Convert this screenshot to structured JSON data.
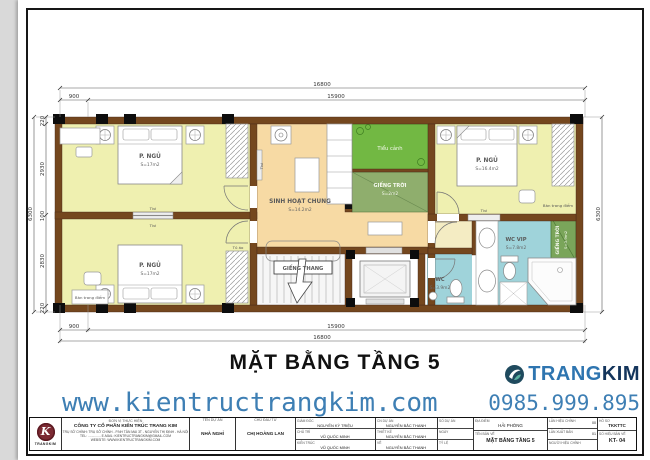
{
  "sheet": {
    "title": "MẶT BẰNG TẦNG 5"
  },
  "dims": {
    "total": "16800",
    "left": "900",
    "main": "15900",
    "height_total": "6300",
    "h_segments": [
      "220",
      "2930",
      "100",
      "2830",
      "220"
    ]
  },
  "rooms": {
    "bedroom1": {
      "name": "P. NGỦ",
      "area": "S=17m2"
    },
    "bedroom2": {
      "name": "P. NGỦ",
      "area": "S=17m2"
    },
    "bedroom3": {
      "name": "P. NGỦ",
      "area": "S=16.4m2"
    },
    "living": {
      "name": "SINH HOẠT CHUNG",
      "area": "S=14.2m2"
    },
    "garden": {
      "name": "Tiểu cảnh"
    },
    "skylight_mid": {
      "name": "GIẾNG TRỜI",
      "area": "S=2m2"
    },
    "skylight_right": {
      "name": "GIẾNG TRỜI",
      "area": "S=3.9m2"
    },
    "stairwell": {
      "name": "GIẾNG THANG"
    },
    "wc": {
      "name": "WC",
      "area": "S=3.9m2"
    },
    "wc_vip": {
      "name": "WC VIP",
      "area": "S=7.8m2"
    }
  },
  "furniture": {
    "tv": "Tivi",
    "wardrobe": "Tủ áo",
    "dressing_table": "Bàn trang điểm"
  },
  "footer": {
    "website": "www.kientructrangkim.com",
    "phone": "0985.999.895",
    "brand_part1": "TRANG",
    "brand_part2": "KIM"
  },
  "titleblock": {
    "unit_header": "ĐƠN VỊ THỰC HIỆN",
    "company": "CÔNG TY CỔ PHẦN KIẾN TRÚC TRANG KIM",
    "address": "TRỤ SỞ CHÍNH: TRỤ SỞ CHÍNH - P.NH TÂN MAI 3T - NGUYỄN THỊ ĐỊNH - HÀ NỘI",
    "tel_line": "TEL: ..............  E-MAIL: KIENTRUCTRANGKIM@GMAIL.COM",
    "website_line": "WEBSITE: WWW.KIENTRUCTRANGKIM.COM",
    "logo_caption": "TRANGKIM",
    "project_label": "TÊN DỰ ÁN",
    "project_value": "NHÀ NGHỈ",
    "investor_label": "CHỦ ĐẦU TƯ",
    "investor_value": "CHỊ HOÀNG LAN",
    "director_label": "GIÁM ĐỐC",
    "director_value": "NGUYỄN KỲ TRIỆU",
    "lead_label": "CHỦ TRÌ",
    "lead_value": "VŨ QUỐC MINH",
    "arch_label": "KIẾN TRÚC",
    "arch_value": "VŨ QUỐC MINH",
    "pm_label": "CN DỰ ÁN",
    "pm_value": "NGUYỄN BẮC THANH",
    "design_label": "THIẾT KẾ",
    "design_value": "NGUYỄN BẮC THANH",
    "draw_label": "VẼ",
    "draw_value": "NGUYỄN BẮC THANH",
    "projno_label": "SỐ DỰ ÁN",
    "projno_value": "",
    "date_label": "NGÀY",
    "date_value": "",
    "scale_label": "TỶ LỆ",
    "scale_value": "",
    "location_label": "ĐỊA ĐIỂM",
    "location_value": "HẢI PHÒNG",
    "drawing_label": "TÊN BẢN VẼ",
    "drawing_value": "MẶT BẰNG TẦNG 5",
    "rev_label": "LẦN HIỆU CHỈNH",
    "rev_value": "00",
    "edition_label": "LẦN XUẤT BẢN",
    "edition_value": "01",
    "editor_label": "NGƯỜI HIỆU CHỈNH",
    "editor_value": "",
    "doc_label": "HỒ SƠ",
    "doc_value": "TKKTTC",
    "sheet_label": "SỐ HIỆU BẢN VẼ",
    "sheet_value": "KT- 04"
  },
  "colors": {
    "wall_brown": "#74471E",
    "bedroom_yellow": "#EFF0B0",
    "living_tan": "#F7DAA4",
    "corridor_pale": "#F4ECC3",
    "garden_green": "#72B843",
    "skylight_olive": "#8FAE6D",
    "skylight_green": "#7AA55A",
    "wc_blue": "#9FD3DA",
    "accent_blue": "#3E7FB4",
    "brand_navy": "#14355C",
    "logo_red": "#7C2A33"
  }
}
